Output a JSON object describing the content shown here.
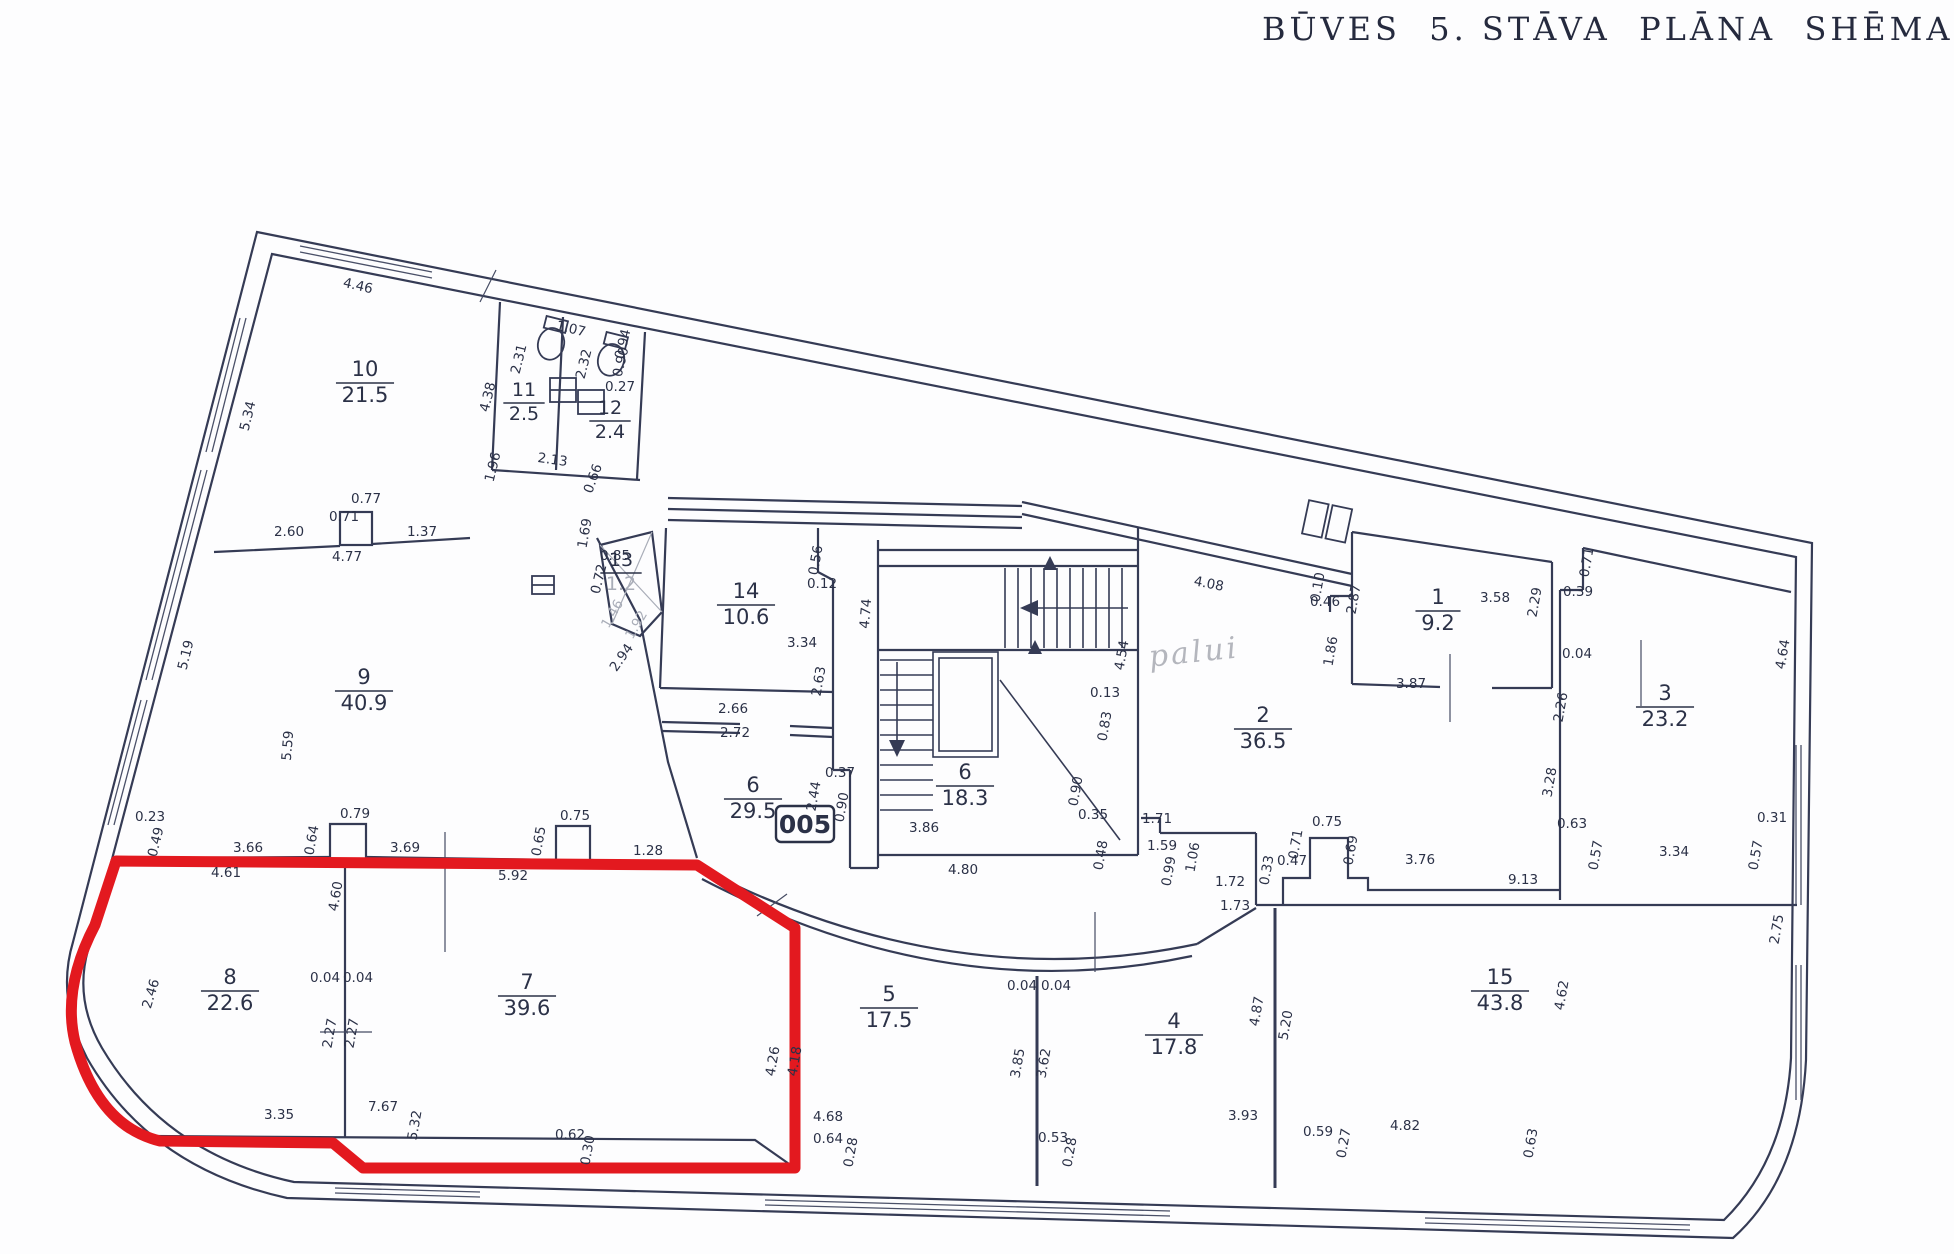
{
  "title": "BŪVES  5. STĀVA  PLĀNA  SHĒMA",
  "boxed_label": "005",
  "note": {
    "text": "palui"
  },
  "colors": {
    "ink": "#2b3147",
    "red": "#e3191f",
    "muted": "#a9adb8",
    "paper": "#fdfdfe"
  },
  "rooms": [
    {
      "n": "1",
      "a": "9.2",
      "x": 1438,
      "y": 604
    },
    {
      "n": "2",
      "a": "36.5",
      "x": 1263,
      "y": 722
    },
    {
      "n": "3",
      "a": "23.2",
      "x": 1665,
      "y": 700
    },
    {
      "n": "4",
      "a": "17.8",
      "x": 1174,
      "y": 1028
    },
    {
      "n": "5",
      "a": "17.5",
      "x": 889,
      "y": 1001
    },
    {
      "n": "6",
      "a": "29.5",
      "x": 753,
      "y": 792
    },
    {
      "n": "6",
      "a": "18.3",
      "x": 965,
      "y": 779
    },
    {
      "n": "7",
      "a": "39.6",
      "x": 527,
      "y": 989
    },
    {
      "n": "8",
      "a": "22.6",
      "x": 230,
      "y": 984
    },
    {
      "n": "9",
      "a": "40.9",
      "x": 364,
      "y": 684
    },
    {
      "n": "10",
      "a": "21.5",
      "x": 365,
      "y": 376
    },
    {
      "n": "11",
      "a": "2.5",
      "x": 524,
      "y": 396,
      "fs": 19
    },
    {
      "n": "12",
      "a": "2.4",
      "x": 610,
      "y": 414,
      "fs": 19
    },
    {
      "n": "13",
      "a": "1.2",
      "x": 621,
      "y": 566,
      "fs": 19,
      "muted": true
    },
    {
      "n": "14",
      "a": "10.6",
      "x": 746,
      "y": 598
    },
    {
      "n": "15",
      "a": "43.8",
      "x": 1500,
      "y": 984
    }
  ],
  "dims": [
    {
      "t": "4.46",
      "x": 357,
      "y": 290,
      "r": 13
    },
    {
      "t": "5.34",
      "x": 252,
      "y": 417,
      "r": -76
    },
    {
      "t": "2.60",
      "x": 289,
      "y": 536
    },
    {
      "t": "0.71",
      "x": 344,
      "y": 521
    },
    {
      "t": "0.77",
      "x": 366,
      "y": 503
    },
    {
      "t": "4.77",
      "x": 347,
      "y": 561
    },
    {
      "t": "1.37",
      "x": 422,
      "y": 536
    },
    {
      "t": "2.31",
      "x": 523,
      "y": 360,
      "r": -76
    },
    {
      "t": "4.38",
      "x": 492,
      "y": 398,
      "r": -76
    },
    {
      "t": "1.07",
      "x": 570,
      "y": 333,
      "r": 13
    },
    {
      "t": "0.94",
      "x": 627,
      "y": 345,
      "r": -76
    },
    {
      "t": "0.90",
      "x": 625,
      "y": 363,
      "r": -76
    },
    {
      "t": "2.32",
      "x": 588,
      "y": 365,
      "r": -76
    },
    {
      "t": "0.27",
      "x": 620,
      "y": 391
    },
    {
      "t": "2.13",
      "x": 552,
      "y": 464,
      "r": 8
    },
    {
      "t": "1.96",
      "x": 497,
      "y": 468,
      "r": -76
    },
    {
      "t": "0.66",
      "x": 597,
      "y": 480,
      "r": -70
    },
    {
      "t": "5.19",
      "x": 190,
      "y": 656,
      "r": -76
    },
    {
      "t": "5.59",
      "x": 292,
      "y": 746,
      "r": -85
    },
    {
      "t": "0.23",
      "x": 150,
      "y": 821
    },
    {
      "t": "0.49",
      "x": 160,
      "y": 843,
      "r": -76
    },
    {
      "t": "2.46",
      "x": 155,
      "y": 995,
      "r": -73
    },
    {
      "t": "0.85",
      "x": 615,
      "y": 560
    },
    {
      "t": "0.72",
      "x": 603,
      "y": 580,
      "r": -76
    },
    {
      "t": "1.69",
      "x": 589,
      "y": 534,
      "r": -80
    },
    {
      "t": "1.46",
      "x": 616,
      "y": 616,
      "r": -60,
      "g": true
    },
    {
      "t": "1.92",
      "x": 640,
      "y": 627,
      "r": -60,
      "g": true
    },
    {
      "t": "2.94",
      "x": 625,
      "y": 660,
      "r": -55
    },
    {
      "t": "0.56",
      "x": 820,
      "y": 561,
      "r": -80
    },
    {
      "t": "0.12",
      "x": 822,
      "y": 588
    },
    {
      "t": "3.34",
      "x": 802,
      "y": 647
    },
    {
      "t": "4.74",
      "x": 870,
      "y": 614,
      "r": -85
    },
    {
      "t": "2.63",
      "x": 823,
      "y": 682,
      "r": -80
    },
    {
      "t": "2.66",
      "x": 733,
      "y": 713
    },
    {
      "t": "2.72",
      "x": 735,
      "y": 737
    },
    {
      "t": "0.37",
      "x": 840,
      "y": 777
    },
    {
      "t": "2.44",
      "x": 818,
      "y": 797,
      "r": -80
    },
    {
      "t": "0.90",
      "x": 846,
      "y": 808,
      "r": -80
    },
    {
      "t": "3.86",
      "x": 924,
      "y": 832
    },
    {
      "t": "4.80",
      "x": 963,
      "y": 874
    },
    {
      "t": "4.54",
      "x": 1126,
      "y": 656,
      "r": -80
    },
    {
      "t": "0.13",
      "x": 1105,
      "y": 697
    },
    {
      "t": "0.83",
      "x": 1109,
      "y": 727,
      "r": -80
    },
    {
      "t": "0.90",
      "x": 1080,
      "y": 792,
      "r": -80
    },
    {
      "t": "0.35",
      "x": 1093,
      "y": 819
    },
    {
      "t": "1.71",
      "x": 1157,
      "y": 823
    },
    {
      "t": "0.48",
      "x": 1105,
      "y": 856,
      "r": -80
    },
    {
      "t": "1.59",
      "x": 1162,
      "y": 850
    },
    {
      "t": "0.99",
      "x": 1173,
      "y": 872,
      "r": -80
    },
    {
      "t": "1.06",
      "x": 1197,
      "y": 858,
      "r": -80
    },
    {
      "t": "1.72",
      "x": 1230,
      "y": 886
    },
    {
      "t": "1.73",
      "x": 1235,
      "y": 910
    },
    {
      "t": "0.33",
      "x": 1271,
      "y": 871,
      "r": -80
    },
    {
      "t": "0.47",
      "x": 1292,
      "y": 865
    },
    {
      "t": "0.71",
      "x": 1300,
      "y": 845,
      "r": -80
    },
    {
      "t": "0.75",
      "x": 1327,
      "y": 826
    },
    {
      "t": "0.69",
      "x": 1355,
      "y": 851,
      "r": -80
    },
    {
      "t": "3.76",
      "x": 1420,
      "y": 864
    },
    {
      "t": "4.08",
      "x": 1208,
      "y": 588,
      "r": 11
    },
    {
      "t": "0.10",
      "x": 1322,
      "y": 588,
      "r": -80
    },
    {
      "t": "0.46",
      "x": 1325,
      "y": 606
    },
    {
      "t": "1.86",
      "x": 1335,
      "y": 652,
      "r": -80
    },
    {
      "t": "2.87",
      "x": 1358,
      "y": 600,
      "r": -80
    },
    {
      "t": "3.58",
      "x": 1495,
      "y": 602
    },
    {
      "t": "2.29",
      "x": 1539,
      "y": 603,
      "r": -80
    },
    {
      "t": "3.87",
      "x": 1411,
      "y": 688
    },
    {
      "t": "0.71",
      "x": 1591,
      "y": 563,
      "r": -80
    },
    {
      "t": "0.39",
      "x": 1578,
      "y": 596
    },
    {
      "t": "0.04",
      "x": 1577,
      "y": 658
    },
    {
      "t": "2.26",
      "x": 1565,
      "y": 708,
      "r": -80
    },
    {
      "t": "4.64",
      "x": 1787,
      "y": 655,
      "r": -80
    },
    {
      "t": "3.28",
      "x": 1554,
      "y": 783,
      "r": -80
    },
    {
      "t": "0.63",
      "x": 1572,
      "y": 828
    },
    {
      "t": "0.57",
      "x": 1600,
      "y": 856,
      "r": -80
    },
    {
      "t": "3.34",
      "x": 1674,
      "y": 856
    },
    {
      "t": "0.57",
      "x": 1760,
      "y": 856,
      "r": -80
    },
    {
      "t": "0.31",
      "x": 1772,
      "y": 822
    },
    {
      "t": "9.13",
      "x": 1523,
      "y": 884
    },
    {
      "t": "2.75",
      "x": 1781,
      "y": 930,
      "r": -80
    },
    {
      "t": "3.66",
      "x": 248,
      "y": 852
    },
    {
      "t": "4.61",
      "x": 226,
      "y": 877
    },
    {
      "t": "0.64",
      "x": 316,
      "y": 841,
      "r": -80
    },
    {
      "t": "0.79",
      "x": 355,
      "y": 818
    },
    {
      "t": "3.69",
      "x": 405,
      "y": 852
    },
    {
      "t": "4.60",
      "x": 340,
      "y": 897,
      "r": -80
    },
    {
      "t": "5.92",
      "x": 513,
      "y": 880
    },
    {
      "t": "0.65",
      "x": 543,
      "y": 842,
      "r": -80
    },
    {
      "t": "0.75",
      "x": 575,
      "y": 820
    },
    {
      "t": "1.28",
      "x": 648,
      "y": 855
    },
    {
      "t": "0.04",
      "x": 325,
      "y": 982
    },
    {
      "t": "0.04",
      "x": 358,
      "y": 982
    },
    {
      "t": "2.27",
      "x": 334,
      "y": 1034,
      "r": -80
    },
    {
      "t": "2.27",
      "x": 356,
      "y": 1034,
      "r": -80
    },
    {
      "t": "3.35",
      "x": 279,
      "y": 1119
    },
    {
      "t": "7.67",
      "x": 383,
      "y": 1111
    },
    {
      "t": "5.32",
      "x": 419,
      "y": 1126,
      "r": -80
    },
    {
      "t": "0.62",
      "x": 570,
      "y": 1139
    },
    {
      "t": "0.30",
      "x": 592,
      "y": 1151,
      "r": -80
    },
    {
      "t": "4.26",
      "x": 777,
      "y": 1062,
      "r": -80
    },
    {
      "t": "4.18",
      "x": 799,
      "y": 1062,
      "r": -80
    },
    {
      "t": "0.64",
      "x": 828,
      "y": 1143
    },
    {
      "t": "0.28",
      "x": 855,
      "y": 1153,
      "r": -80
    },
    {
      "t": "4.68",
      "x": 828,
      "y": 1121
    },
    {
      "t": "0.04",
      "x": 1022,
      "y": 990
    },
    {
      "t": "0.04",
      "x": 1056,
      "y": 990
    },
    {
      "t": "3.85",
      "x": 1022,
      "y": 1064,
      "r": -80
    },
    {
      "t": "3.62",
      "x": 1048,
      "y": 1064,
      "r": -80
    },
    {
      "t": "0.53",
      "x": 1053,
      "y": 1142
    },
    {
      "t": "0.28",
      "x": 1074,
      "y": 1153,
      "r": -80
    },
    {
      "t": "3.93",
      "x": 1243,
      "y": 1120
    },
    {
      "t": "0.59",
      "x": 1318,
      "y": 1136
    },
    {
      "t": "0.27",
      "x": 1348,
      "y": 1144,
      "r": -80
    },
    {
      "t": "4.82",
      "x": 1405,
      "y": 1130
    },
    {
      "t": "0.63",
      "x": 1535,
      "y": 1144,
      "r": -80
    },
    {
      "t": "4.87",
      "x": 1261,
      "y": 1012,
      "r": -80
    },
    {
      "t": "5.20",
      "x": 1290,
      "y": 1026,
      "r": -80
    },
    {
      "t": "4.62",
      "x": 1566,
      "y": 996,
      "r": -80
    }
  ]
}
